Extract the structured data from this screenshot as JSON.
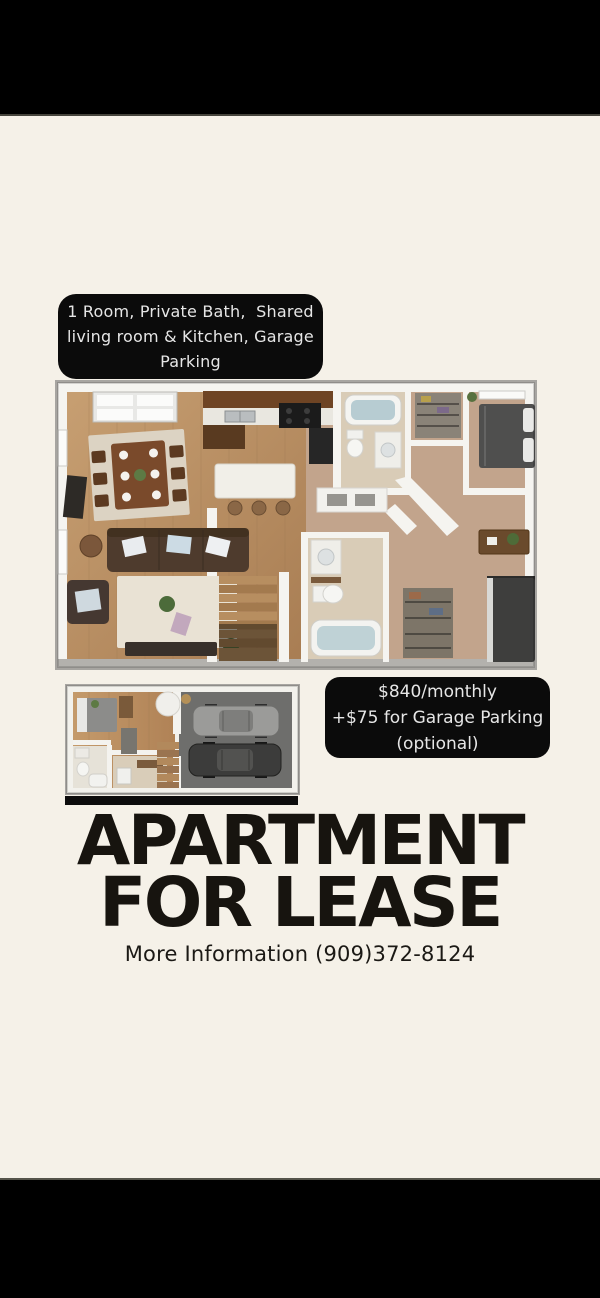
{
  "letterbox": {
    "color": "#000000"
  },
  "flyer": {
    "background_color": "#f5f1e8",
    "features_box": {
      "background": "#0b0b0b",
      "text_color": "#e6e6e6",
      "lines": [
        "1 Room, Private Bath,  Shared",
        "living room & Kitchen, Garage",
        "Parking"
      ]
    },
    "floorplans": {
      "main_alt": "3D top-down apartment floor plan: dining area, kitchen with island, living room with sofa, stairs, hallway, two bathrooms, two bedrooms",
      "garage_alt": "3D top-down lower-level floor plan: bedroom, small bathroom, stairs and two-car garage"
    },
    "price_box": {
      "background": "#0b0b0b",
      "text_color": "#e6e6e6",
      "lines": [
        "$840/monthly",
        "+$75 for Garage Parking",
        "(optional)"
      ]
    },
    "title": {
      "color": "#17140f",
      "lines": [
        "APARTMENT",
        "FOR LEASE"
      ]
    },
    "contact": "More Information (909)372-8124"
  }
}
